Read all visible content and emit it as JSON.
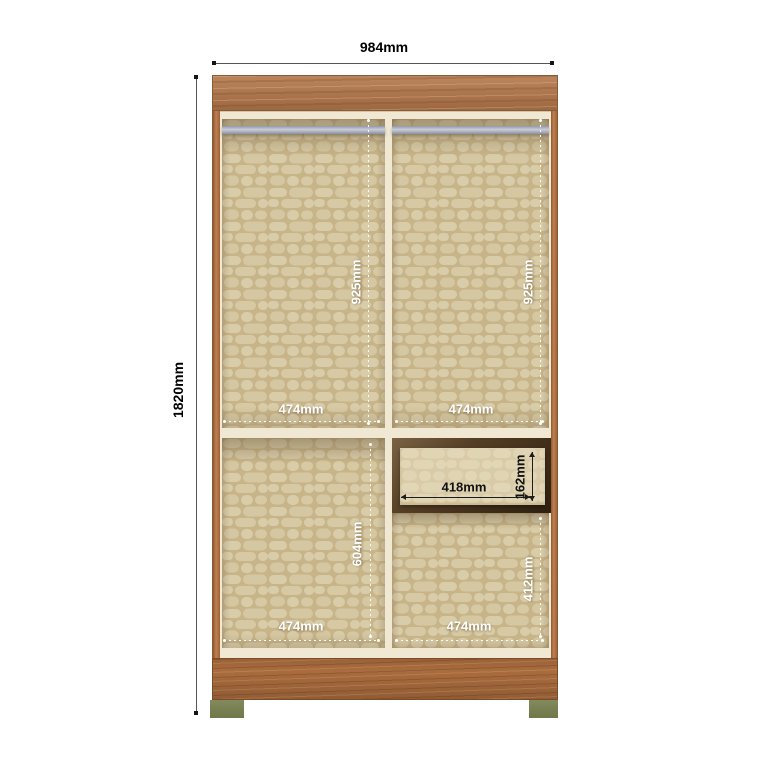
{
  "diagram": {
    "overall": {
      "width": "984mm",
      "height": "1820mm"
    },
    "upper_left": {
      "height": "925mm",
      "width": "474mm"
    },
    "upper_right": {
      "height": "925mm",
      "width": "474mm"
    },
    "lower_left": {
      "height": "604mm",
      "width": "474mm"
    },
    "lower_right": {
      "height": "412mm",
      "width": "474mm"
    },
    "drawer": {
      "width": "418mm",
      "height": "162mm"
    },
    "colors": {
      "wood": "#b3774a",
      "wood_plinth": "#aa6c3e",
      "interior_pattern_base": "#c8b489",
      "interior_pattern_blob": "#d8cca9",
      "shelf_cream": "#f0e8d3",
      "drawer_recess_brown": "#4a3722",
      "drawer_front": "#ece3c6",
      "hanging_rod_gray": "#aab0bf",
      "foot_green": "#788052",
      "outer_dimension_line": "#555555",
      "outer_dimension_text": "#000000",
      "interior_dimension_text": "#ffffff"
    }
  }
}
